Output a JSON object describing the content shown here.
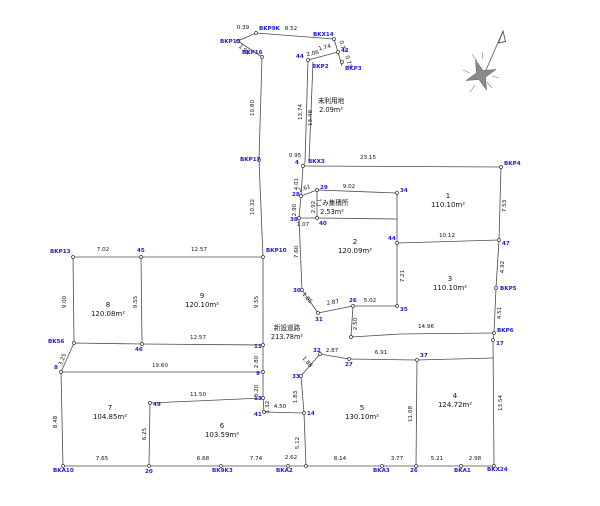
{
  "canvas": {
    "width": 600,
    "height": 506,
    "background": "#ffffff",
    "line_color": "#4a4a4a",
    "dim_color": "#111111",
    "point_label_color": "#1a1acd"
  },
  "drawing": {
    "segments": [
      [
        238,
        41,
        256,
        33
      ],
      [
        256,
        33,
        334,
        39
      ],
      [
        238,
        41,
        262,
        57
      ],
      [
        334,
        39,
        338,
        52
      ],
      [
        338,
        52,
        342,
        66
      ],
      [
        338,
        52,
        308,
        60
      ],
      [
        308,
        60,
        305,
        162
      ],
      [
        313,
        62,
        309,
        162
      ],
      [
        305,
        162,
        303,
        166
      ],
      [
        303,
        166,
        501,
        167
      ],
      [
        501,
        167,
        499,
        240
      ],
      [
        499,
        240,
        397,
        243
      ],
      [
        499,
        240,
        496,
        288
      ],
      [
        496,
        288,
        494,
        333
      ],
      [
        400,
        334,
        494,
        333
      ],
      [
        494,
        333,
        493,
        340
      ],
      [
        493,
        340,
        494,
        466
      ],
      [
        494,
        466,
        63,
        466
      ],
      [
        63,
        466,
        61,
        372
      ],
      [
        61,
        372,
        263,
        372
      ],
      [
        61,
        372,
        74,
        343
      ],
      [
        74,
        343,
        73,
        257
      ],
      [
        73,
        257,
        263,
        257
      ],
      [
        141,
        257,
        142,
        344
      ],
      [
        263,
        257,
        263,
        345
      ],
      [
        74,
        343,
        142,
        344
      ],
      [
        142,
        344,
        263,
        345
      ],
      [
        263,
        345,
        263,
        372
      ],
      [
        263,
        372,
        263,
        398
      ],
      [
        263,
        398,
        264,
        412
      ],
      [
        264,
        412,
        304,
        413
      ],
      [
        304,
        413,
        306,
        466
      ],
      [
        150,
        403,
        263,
        398
      ],
      [
        150,
        403,
        149,
        466
      ],
      [
        262,
        57,
        259,
        160
      ],
      [
        259,
        160,
        263,
        257
      ],
      [
        303,
        166,
        301,
        196
      ],
      [
        301,
        196,
        317,
        190
      ],
      [
        317,
        190,
        397,
        193
      ],
      [
        397,
        193,
        397,
        243
      ],
      [
        301,
        196,
        299,
        218
      ],
      [
        317,
        190,
        317,
        218
      ],
      [
        299,
        218,
        317,
        218
      ],
      [
        317,
        218,
        397,
        219
      ],
      [
        299,
        218,
        302,
        290
      ],
      [
        302,
        290,
        318,
        313
      ],
      [
        318,
        313,
        353,
        306
      ],
      [
        353,
        306,
        397,
        306
      ],
      [
        397,
        243,
        397,
        306
      ],
      [
        353,
        306,
        351,
        337
      ],
      [
        351,
        337,
        400,
        334
      ],
      [
        320,
        354,
        301,
        376
      ],
      [
        301,
        376,
        304,
        413
      ],
      [
        320,
        354,
        349,
        359
      ],
      [
        349,
        359,
        417,
        360
      ],
      [
        417,
        360,
        493,
        358
      ],
      [
        417,
        360,
        416,
        466
      ]
    ],
    "points": [
      [
        238,
        41
      ],
      [
        256,
        33
      ],
      [
        334,
        39
      ],
      [
        338,
        52
      ],
      [
        342,
        62
      ],
      [
        308,
        60
      ],
      [
        262,
        57
      ],
      [
        259,
        160
      ],
      [
        303,
        166
      ],
      [
        501,
        167
      ],
      [
        317,
        190
      ],
      [
        397,
        193
      ],
      [
        301,
        196
      ],
      [
        299,
        218
      ],
      [
        317,
        218
      ],
      [
        73,
        257
      ],
      [
        141,
        257
      ],
      [
        263,
        257
      ],
      [
        397,
        243
      ],
      [
        499,
        240
      ],
      [
        496,
        288
      ],
      [
        302,
        290
      ],
      [
        353,
        306
      ],
      [
        397,
        306
      ],
      [
        318,
        313
      ],
      [
        351,
        337
      ],
      [
        494,
        333
      ],
      [
        493,
        340
      ],
      [
        74,
        343
      ],
      [
        142,
        344
      ],
      [
        263,
        345
      ],
      [
        320,
        354
      ],
      [
        349,
        359
      ],
      [
        417,
        360
      ],
      [
        61,
        372
      ],
      [
        263,
        372
      ],
      [
        301,
        376
      ],
      [
        263,
        398
      ],
      [
        150,
        403
      ],
      [
        264,
        412
      ],
      [
        304,
        413
      ],
      [
        149,
        466
      ],
      [
        63,
        466
      ],
      [
        221,
        466
      ],
      [
        288,
        466
      ],
      [
        306,
        466
      ],
      [
        382,
        466
      ],
      [
        416,
        466
      ],
      [
        461,
        466
      ],
      [
        494,
        466
      ]
    ],
    "dim_labels": [
      {
        "t": "0.39",
        "x": 243,
        "y": 29,
        "r": 0
      },
      {
        "t": "8.52",
        "x": 291,
        "y": 30,
        "r": 0
      },
      {
        "t": "1.96",
        "x": 243,
        "y": 51,
        "r": 40
      },
      {
        "t": "0.77",
        "x": 341,
        "y": 47,
        "r": 75
      },
      {
        "t": "0.73",
        "x": 347,
        "y": 62,
        "r": 75
      },
      {
        "t": "1.74",
        "x": 325,
        "y": 49,
        "r": -13
      },
      {
        "t": "2.06",
        "x": 313,
        "y": 55,
        "r": -13
      },
      {
        "t": "13.74",
        "x": 302,
        "y": 112,
        "r": -90
      },
      {
        "t": "13.48",
        "x": 312,
        "y": 118,
        "r": -90
      },
      {
        "t": "0.95",
        "x": 295,
        "y": 157,
        "r": 0
      },
      {
        "t": "23.15",
        "x": 368,
        "y": 159,
        "r": 0
      },
      {
        "t": "4.01",
        "x": 298,
        "y": 184,
        "r": -90
      },
      {
        "t": "1.61",
        "x": 305,
        "y": 190,
        "r": -20
      },
      {
        "t": "9.02",
        "x": 349,
        "y": 188,
        "r": 0
      },
      {
        "t": "2.92",
        "x": 315,
        "y": 207,
        "r": -90
      },
      {
        "t": "2.90",
        "x": 296,
        "y": 210,
        "r": -90
      },
      {
        "t": "1.07",
        "x": 303,
        "y": 226,
        "r": 0
      },
      {
        "t": "7.60",
        "x": 298,
        "y": 252,
        "r": -90
      },
      {
        "t": "7.53",
        "x": 506,
        "y": 206,
        "r": -90
      },
      {
        "t": "10.12",
        "x": 447,
        "y": 237,
        "r": 0
      },
      {
        "t": "4.92",
        "x": 504,
        "y": 267,
        "r": -90
      },
      {
        "t": "4.51",
        "x": 501,
        "y": 313,
        "r": -90
      },
      {
        "t": "7.21",
        "x": 404,
        "y": 276,
        "r": -90
      },
      {
        "t": "14.96",
        "x": 426,
        "y": 328,
        "r": 0
      },
      {
        "t": "13.54",
        "x": 502,
        "y": 403,
        "r": -90
      },
      {
        "t": "1.85",
        "x": 306,
        "y": 299,
        "r": 50
      },
      {
        "t": "2.87",
        "x": 333,
        "y": 304,
        "r": -8
      },
      {
        "t": "5.02",
        "x": 370,
        "y": 302,
        "r": 0
      },
      {
        "t": "2.50",
        "x": 357,
        "y": 324,
        "r": -90
      },
      {
        "t": "2.87",
        "x": 332,
        "y": 352,
        "r": 0
      },
      {
        "t": "6.91",
        "x": 381,
        "y": 354,
        "r": 0
      },
      {
        "t": "1.88",
        "x": 306,
        "y": 363,
        "r": 50
      },
      {
        "t": "1.83",
        "x": 297,
        "y": 397,
        "r": -90
      },
      {
        "t": "4.50",
        "x": 280,
        "y": 408,
        "r": 0
      },
      {
        "t": "5.12",
        "x": 299,
        "y": 443,
        "r": -90
      },
      {
        "t": "11.08",
        "x": 412,
        "y": 414,
        "r": -90
      },
      {
        "t": "10.80",
        "x": 254,
        "y": 108,
        "r": -90
      },
      {
        "t": "10.32",
        "x": 254,
        "y": 207,
        "r": -90
      },
      {
        "t": "9.00",
        "x": 66,
        "y": 302,
        "r": -90
      },
      {
        "t": "7.02",
        "x": 103,
        "y": 251,
        "r": 0
      },
      {
        "t": "12.57",
        "x": 199,
        "y": 251,
        "r": 0
      },
      {
        "t": "9.55",
        "x": 137,
        "y": 302,
        "r": -90
      },
      {
        "t": "9.55",
        "x": 258,
        "y": 302,
        "r": -90
      },
      {
        "t": "12.57",
        "x": 198,
        "y": 339,
        "r": 0
      },
      {
        "t": "3.25",
        "x": 64,
        "y": 360,
        "r": -70
      },
      {
        "t": "8.48",
        "x": 57,
        "y": 422,
        "r": -90
      },
      {
        "t": "19.60",
        "x": 160,
        "y": 367,
        "r": 0
      },
      {
        "t": "2.80",
        "x": 258,
        "y": 362,
        "r": -90
      },
      {
        "t": "3.20",
        "x": 258,
        "y": 391,
        "r": -90
      },
      {
        "t": "1.32",
        "x": 269,
        "y": 407,
        "r": -90
      },
      {
        "t": "11.50",
        "x": 198,
        "y": 396,
        "r": 0
      },
      {
        "t": "6.25",
        "x": 146,
        "y": 434,
        "r": -90
      },
      {
        "t": "7.65",
        "x": 102,
        "y": 460,
        "r": 0
      },
      {
        "t": "6.68",
        "x": 203,
        "y": 460,
        "r": 0
      },
      {
        "t": "7.74",
        "x": 256,
        "y": 460,
        "r": 0
      },
      {
        "t": "2.62",
        "x": 291,
        "y": 459,
        "r": 0
      },
      {
        "t": "8.14",
        "x": 340,
        "y": 460,
        "r": 0
      },
      {
        "t": "3.77",
        "x": 397,
        "y": 460,
        "r": 0
      },
      {
        "t": "5.21",
        "x": 437,
        "y": 460,
        "r": 0
      },
      {
        "t": "2.98",
        "x": 475,
        "y": 460,
        "r": 0
      }
    ],
    "point_labels": [
      {
        "t": "BKP15",
        "x": 220,
        "y": 43
      },
      {
        "t": "BKP9K",
        "x": 259,
        "y": 30
      },
      {
        "t": "BKX14",
        "x": 313,
        "y": 36
      },
      {
        "t": "42",
        "x": 341,
        "y": 52
      },
      {
        "t": "BKP3",
        "x": 345,
        "y": 70
      },
      {
        "t": "44",
        "x": 296,
        "y": 58
      },
      {
        "t": "BKP2",
        "x": 312,
        "y": 68
      },
      {
        "t": "BKP16",
        "x": 242,
        "y": 54
      },
      {
        "t": "BKP17",
        "x": 240,
        "y": 161
      },
      {
        "t": "4",
        "x": 295,
        "y": 164
      },
      {
        "t": "BKX3",
        "x": 308,
        "y": 163
      },
      {
        "t": "BKP4",
        "x": 504,
        "y": 165
      },
      {
        "t": "47",
        "x": 502,
        "y": 245
      },
      {
        "t": "BKP5",
        "x": 500,
        "y": 290
      },
      {
        "t": "BKP6",
        "x": 497,
        "y": 332
      },
      {
        "t": "17",
        "x": 496,
        "y": 345
      },
      {
        "t": "28",
        "x": 292,
        "y": 196
      },
      {
        "t": "29",
        "x": 320,
        "y": 189
      },
      {
        "t": "34",
        "x": 400,
        "y": 192
      },
      {
        "t": "38",
        "x": 290,
        "y": 221
      },
      {
        "t": "40",
        "x": 319,
        "y": 225
      },
      {
        "t": "BKP13",
        "x": 50,
        "y": 253
      },
      {
        "t": "45",
        "x": 137,
        "y": 252
      },
      {
        "t": "BKP10",
        "x": 266,
        "y": 252
      },
      {
        "t": "44",
        "x": 388,
        "y": 240
      },
      {
        "t": "30",
        "x": 293,
        "y": 292
      },
      {
        "t": "26",
        "x": 349,
        "y": 302
      },
      {
        "t": "35",
        "x": 400,
        "y": 311
      },
      {
        "t": "31",
        "x": 315,
        "y": 321
      },
      {
        "t": "32",
        "x": 313,
        "y": 352
      },
      {
        "t": "27",
        "x": 345,
        "y": 366
      },
      {
        "t": "37",
        "x": 420,
        "y": 357
      },
      {
        "t": "33",
        "x": 292,
        "y": 378
      },
      {
        "t": "11",
        "x": 254,
        "y": 348
      },
      {
        "t": "9",
        "x": 256,
        "y": 375
      },
      {
        "t": "13",
        "x": 254,
        "y": 400
      },
      {
        "t": "41",
        "x": 254,
        "y": 416
      },
      {
        "t": "14",
        "x": 307,
        "y": 415
      },
      {
        "t": "49",
        "x": 153,
        "y": 406
      },
      {
        "t": "46",
        "x": 135,
        "y": 351
      },
      {
        "t": "BK56",
        "x": 48,
        "y": 343
      },
      {
        "t": "8",
        "x": 54,
        "y": 369
      },
      {
        "t": "20",
        "x": 145,
        "y": 473
      },
      {
        "t": "BKA10",
        "x": 53,
        "y": 472
      },
      {
        "t": "BK9K3",
        "x": 212,
        "y": 472
      },
      {
        "t": "BKA2",
        "x": 276,
        "y": 472
      },
      {
        "t": "BKA3",
        "x": 373,
        "y": 472
      },
      {
        "t": "26",
        "x": 410,
        "y": 472
      },
      {
        "t": "BKA1",
        "x": 454,
        "y": 472
      },
      {
        "t": "BKX24",
        "x": 487,
        "y": 471
      }
    ],
    "plots": [
      {
        "num": "1",
        "area": "110.10m²",
        "x": 448,
        "y": 198
      },
      {
        "num": "2",
        "area": "120.09m²",
        "x": 355,
        "y": 244
      },
      {
        "num": "3",
        "area": "110.10m²",
        "x": 450,
        "y": 281
      },
      {
        "num": "4",
        "area": "124.72m²",
        "x": 455,
        "y": 398
      },
      {
        "num": "5",
        "area": "130.10m²",
        "x": 362,
        "y": 410
      },
      {
        "num": "6",
        "area": "103.59m²",
        "x": 222,
        "y": 428
      },
      {
        "num": "7",
        "area": "104.85m²",
        "x": 110,
        "y": 410
      },
      {
        "num": "8",
        "area": "120.08m²",
        "x": 108,
        "y": 307
      },
      {
        "num": "9",
        "area": "120.10m²",
        "x": 202,
        "y": 298
      }
    ],
    "special_areas": [
      {
        "lines": [
          "未利用地",
          "2.09m²"
        ],
        "x": 331,
        "y": 103
      },
      {
        "lines": [
          "ごみ集積所",
          "2.53m²"
        ],
        "x": 332,
        "y": 205
      },
      {
        "lines": [
          "新設道路",
          "213.78m²"
        ],
        "x": 287,
        "y": 330
      }
    ],
    "north_arrow": {
      "star": "496,69.5 483.1,70.5 475.5,60 476.5,72.9 466,80.5 478.9,79.5 486.5,90 485.5,77.1",
      "shaft": [
        486,
        70,
        503,
        31
      ],
      "head": "503,31 498.5,43 505.5,41.5",
      "spikes": [
        [
          463,
          70,
          470,
          73
        ],
        [
          472,
          54,
          477,
          61
        ],
        [
          492,
          88,
          487,
          82
        ],
        [
          470,
          92,
          475,
          85
        ],
        [
          499,
          78,
          492,
          76
        ],
        [
          482,
          52,
          483,
          59
        ]
      ]
    }
  }
}
